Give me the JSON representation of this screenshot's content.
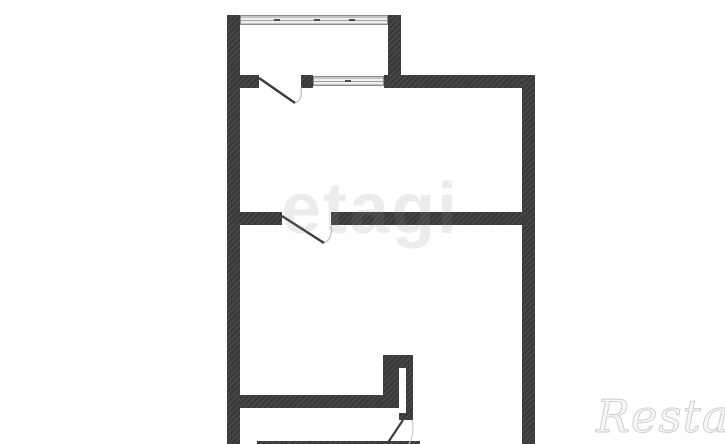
{
  "page": {
    "title": "Floor plan",
    "background_color": "#ffffff"
  },
  "watermarks": {
    "center_text": "etagi",
    "center_color": "rgba(135,135,135,0.16)",
    "corner_text": "Restate",
    "corner_stroke_color": "#cfcfcf"
  },
  "plan": {
    "wall_color": "#3a3a3a",
    "window_symbol_color": "#e3e3e3",
    "window_count": 2,
    "door_swing_count": 3
  }
}
